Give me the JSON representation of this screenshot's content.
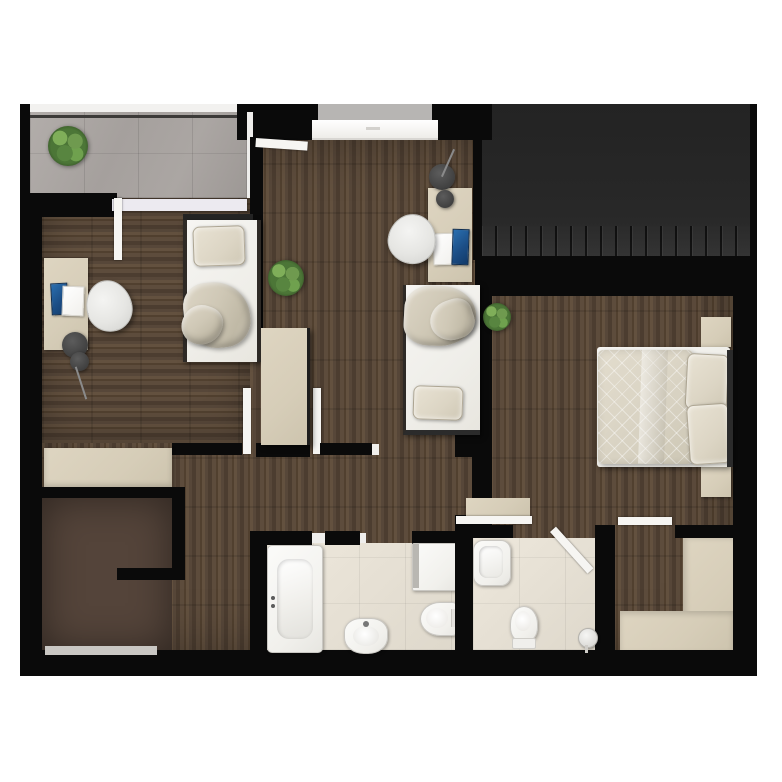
{
  "meta": {
    "title": "Top-down 3D rendered apartment floor plan",
    "floor_type": "upper floor with winder staircase",
    "canvas": {
      "width": 782,
      "height": 782
    },
    "visible_text": "none"
  },
  "palette": {
    "wall": "#0a0a0a",
    "wood_floor": "#55453a",
    "wood_floor_light": "#63513f",
    "balcony_tile": "#a9a4a1",
    "bathroom_tile": "#e6e0d4",
    "roof_panel": "#272727",
    "furniture_beige": "#d6cdb8",
    "fixture_white": "#f4f3f0",
    "textile_beige": "#d6cfc0",
    "plant_green": "#5d8544",
    "laptop_blue": "#1c4e86",
    "lamp_gray": "#4a4a4a",
    "window_sill": "#c9c7c3",
    "door_white": "#f6f5f2"
  },
  "rooms": [
    {
      "id": "balcony",
      "label": "balcony terrace",
      "floor": "gray ceramic tile",
      "items": [
        "potted-plant",
        "railing",
        "sliding-door"
      ]
    },
    {
      "id": "bedroom-left",
      "label": "left bedroom / study",
      "floor": "dark wood planks",
      "items": [
        "desk",
        "office-chair",
        "laptop",
        "notebook",
        "floor-lamp",
        "single-bed",
        "pillow",
        "blanket",
        "sideboard"
      ]
    },
    {
      "id": "bedroom-middle",
      "label": "middle bedroom / study",
      "floor": "dark wood planks",
      "items": [
        "entry-door",
        "french-window",
        "wardrobe",
        "potted-plant",
        "desk",
        "office-chair",
        "laptop",
        "notebook",
        "floor-lamp",
        "single-bed",
        "pillow",
        "blanket"
      ]
    },
    {
      "id": "bedroom-master",
      "label": "master bedroom (right)",
      "floor": "dark wood planks",
      "items": [
        "potted-plant",
        "double-bed",
        "quilted-duvet",
        "pillow",
        "pillow",
        "nightstand",
        "nightstand",
        "built-in-wardrobe",
        "wall-niche-shelf"
      ]
    },
    {
      "id": "hallway",
      "label": "hallway / landing",
      "floor": "dark wood planks",
      "items": [
        "open-door",
        "open-door",
        "door-jamb"
      ]
    },
    {
      "id": "bathroom-1",
      "label": "main bathroom",
      "floor": "cream tile",
      "items": [
        "bathtub",
        "washbasin",
        "shower-tray",
        "toilet"
      ]
    },
    {
      "id": "bathroom-2",
      "label": "second bathroom",
      "floor": "cream tile",
      "items": [
        "small-bathtub",
        "toilet",
        "shower-stand",
        "open-door"
      ]
    },
    {
      "id": "staircase",
      "label": "winder staircase",
      "floor": "wood treads",
      "items": [
        "fan-treads",
        "bottom-window"
      ]
    },
    {
      "id": "roof-section",
      "label": "dark roof / skylight band (top right)",
      "floor": "charcoal panels with ribbed lower edge",
      "items": []
    }
  ]
}
